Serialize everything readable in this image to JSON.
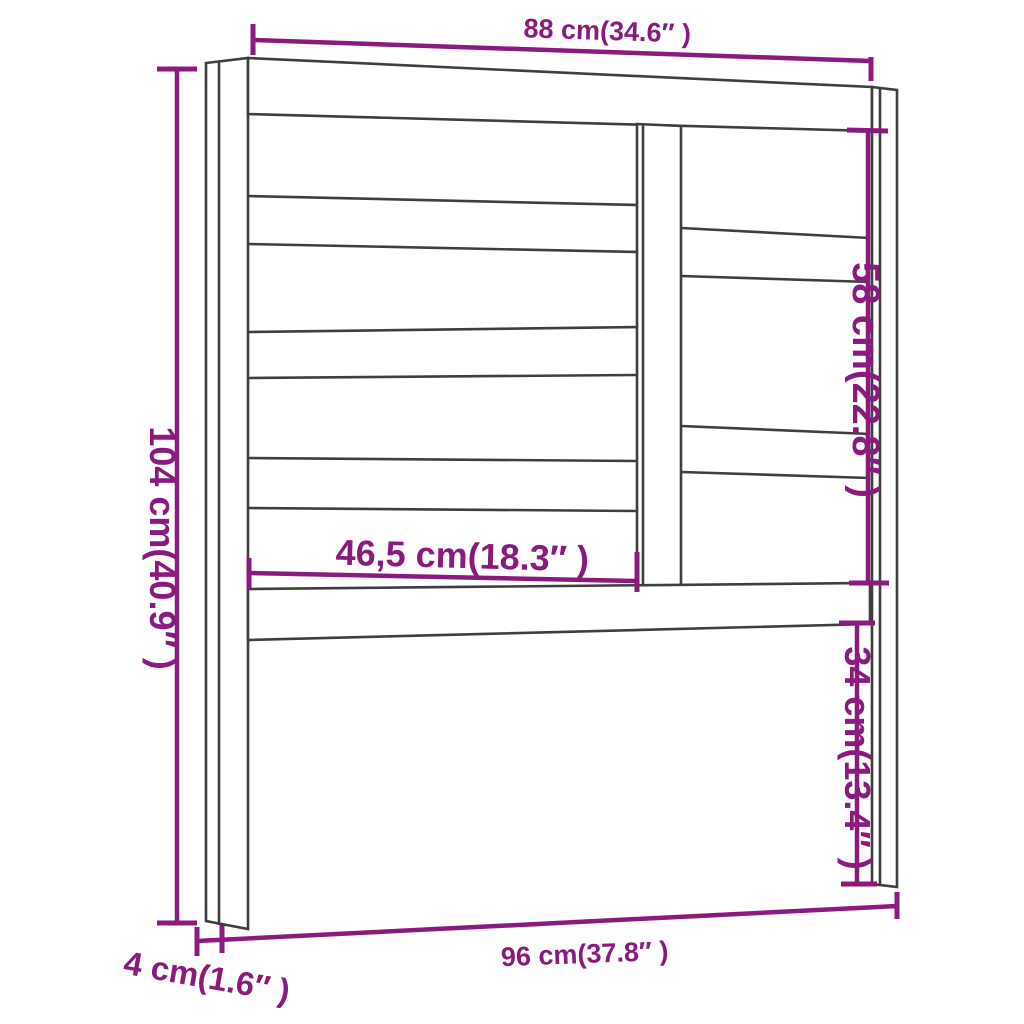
{
  "diagram": {
    "subject": "headboard dimension drawing",
    "style": "technical line drawing with dimension annotations",
    "colors": {
      "dimension_accent": "#8A1A7D",
      "outline": "#3E3E3E",
      "background": "#FFFFFF"
    }
  },
  "labels": {
    "top_width": "88 cm(34.6″ )",
    "overall_height": "104 cm(40.9″ )",
    "upper_right_height": "58 cm(22.8″ )",
    "inner_slat_width": "46,5 cm(18.3″ )",
    "lower_right_height": "34 cm(13.4″ )",
    "bottom_width": "96 cm(37.8″ )",
    "leg_depth": "4 cm(1.6″ )"
  }
}
